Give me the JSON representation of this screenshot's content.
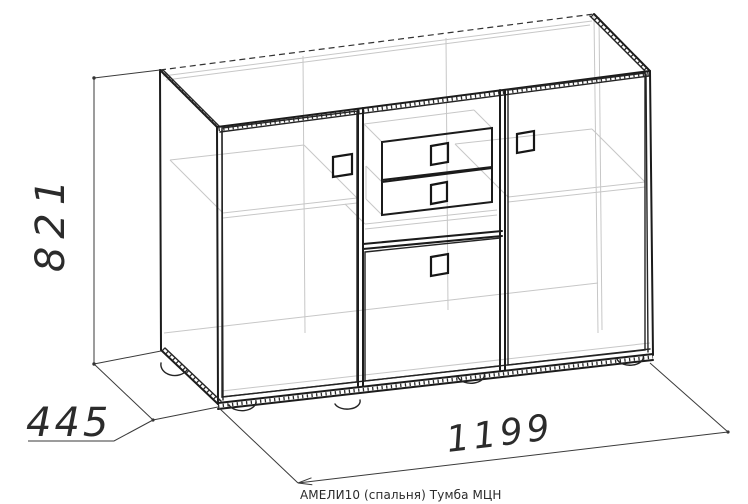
{
  "drawing": {
    "caption": "АМЕЛИ10 (спальня) Тумба МЦН",
    "dimensions": {
      "height": "821",
      "depth": "445",
      "width": "1199"
    },
    "colors": {
      "background": "#ffffff",
      "outline": "#1b1b1b",
      "hidden_lines": "#c7c7c7",
      "dimension_lines": "#3a3a3a",
      "text": "#2b2b2b"
    }
  }
}
